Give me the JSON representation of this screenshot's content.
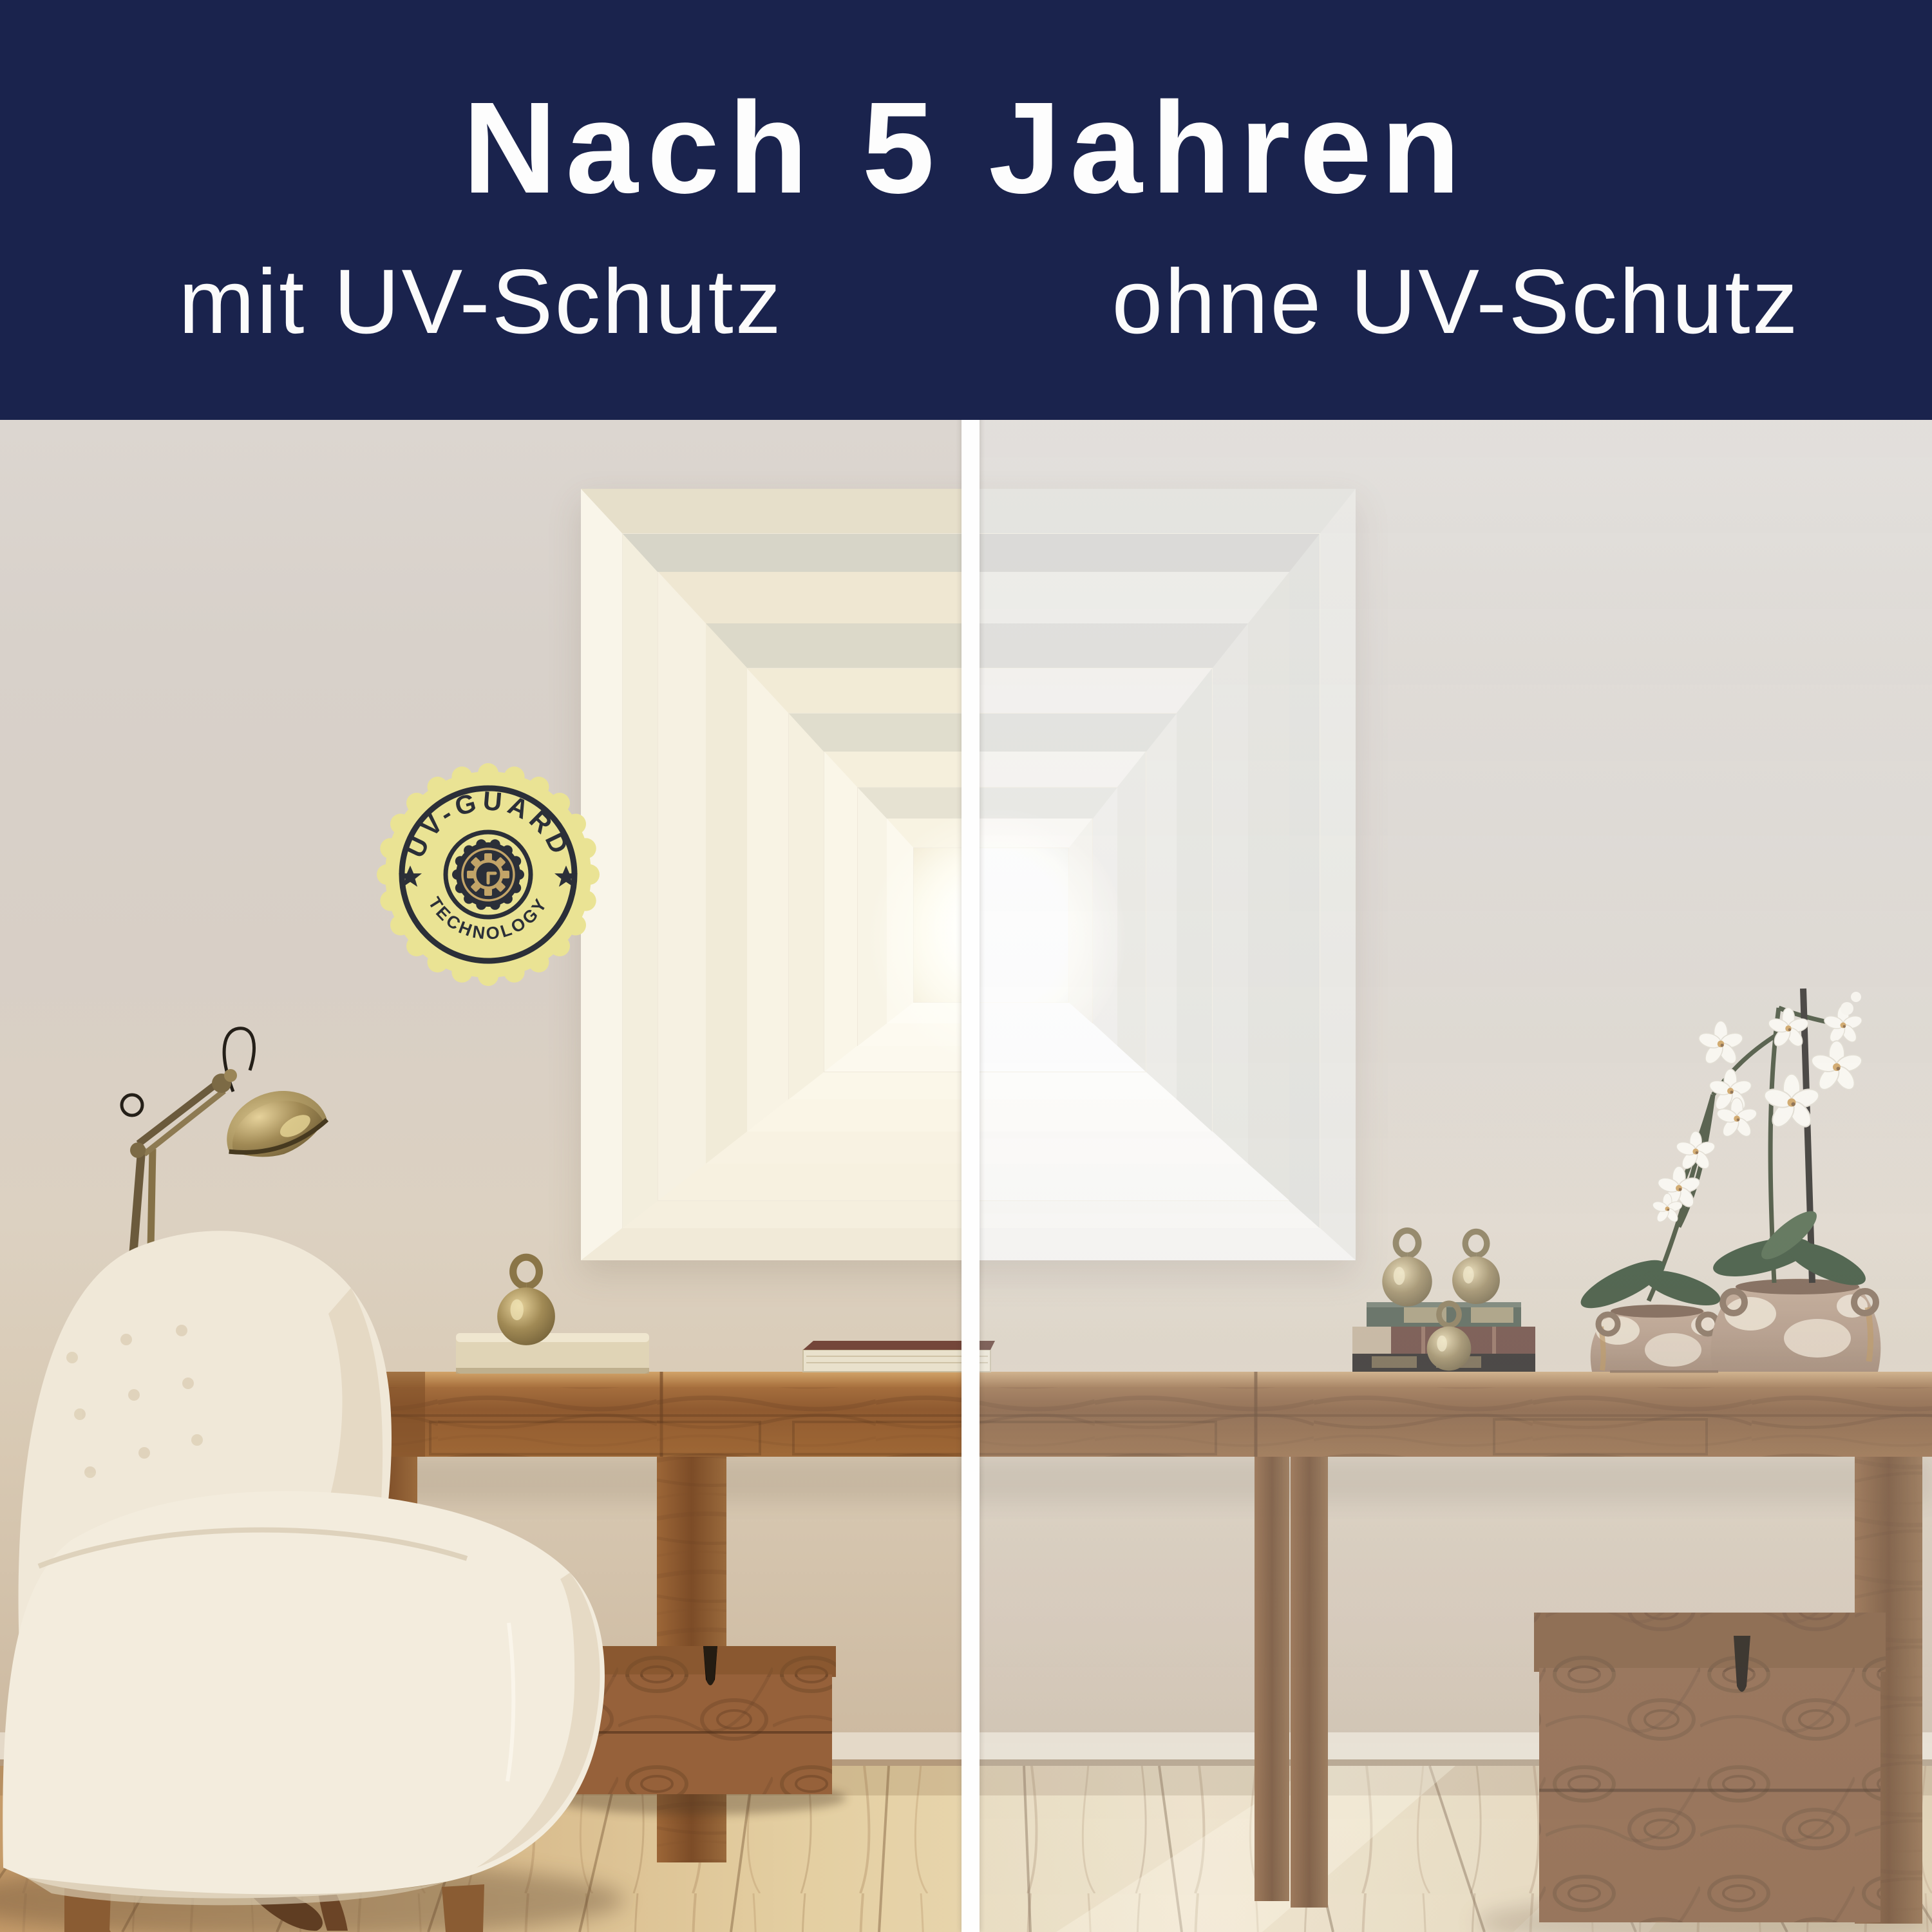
{
  "banner": {
    "title": "Nach 5 Jahren",
    "left_label": "mit UV-Schutz",
    "right_label": "ohne UV-Schutz",
    "bg_color": "#1a234d",
    "text_color": "#fdfdfd"
  },
  "badge": {
    "arc_top": "UV-GUARD",
    "arc_bottom": "TECHNOLOGY",
    "seal_color": "#eae394",
    "emblem_color": "#2b2f38",
    "gold_color": "#c2a468"
  },
  "divider_color": "#fefefe"
}
